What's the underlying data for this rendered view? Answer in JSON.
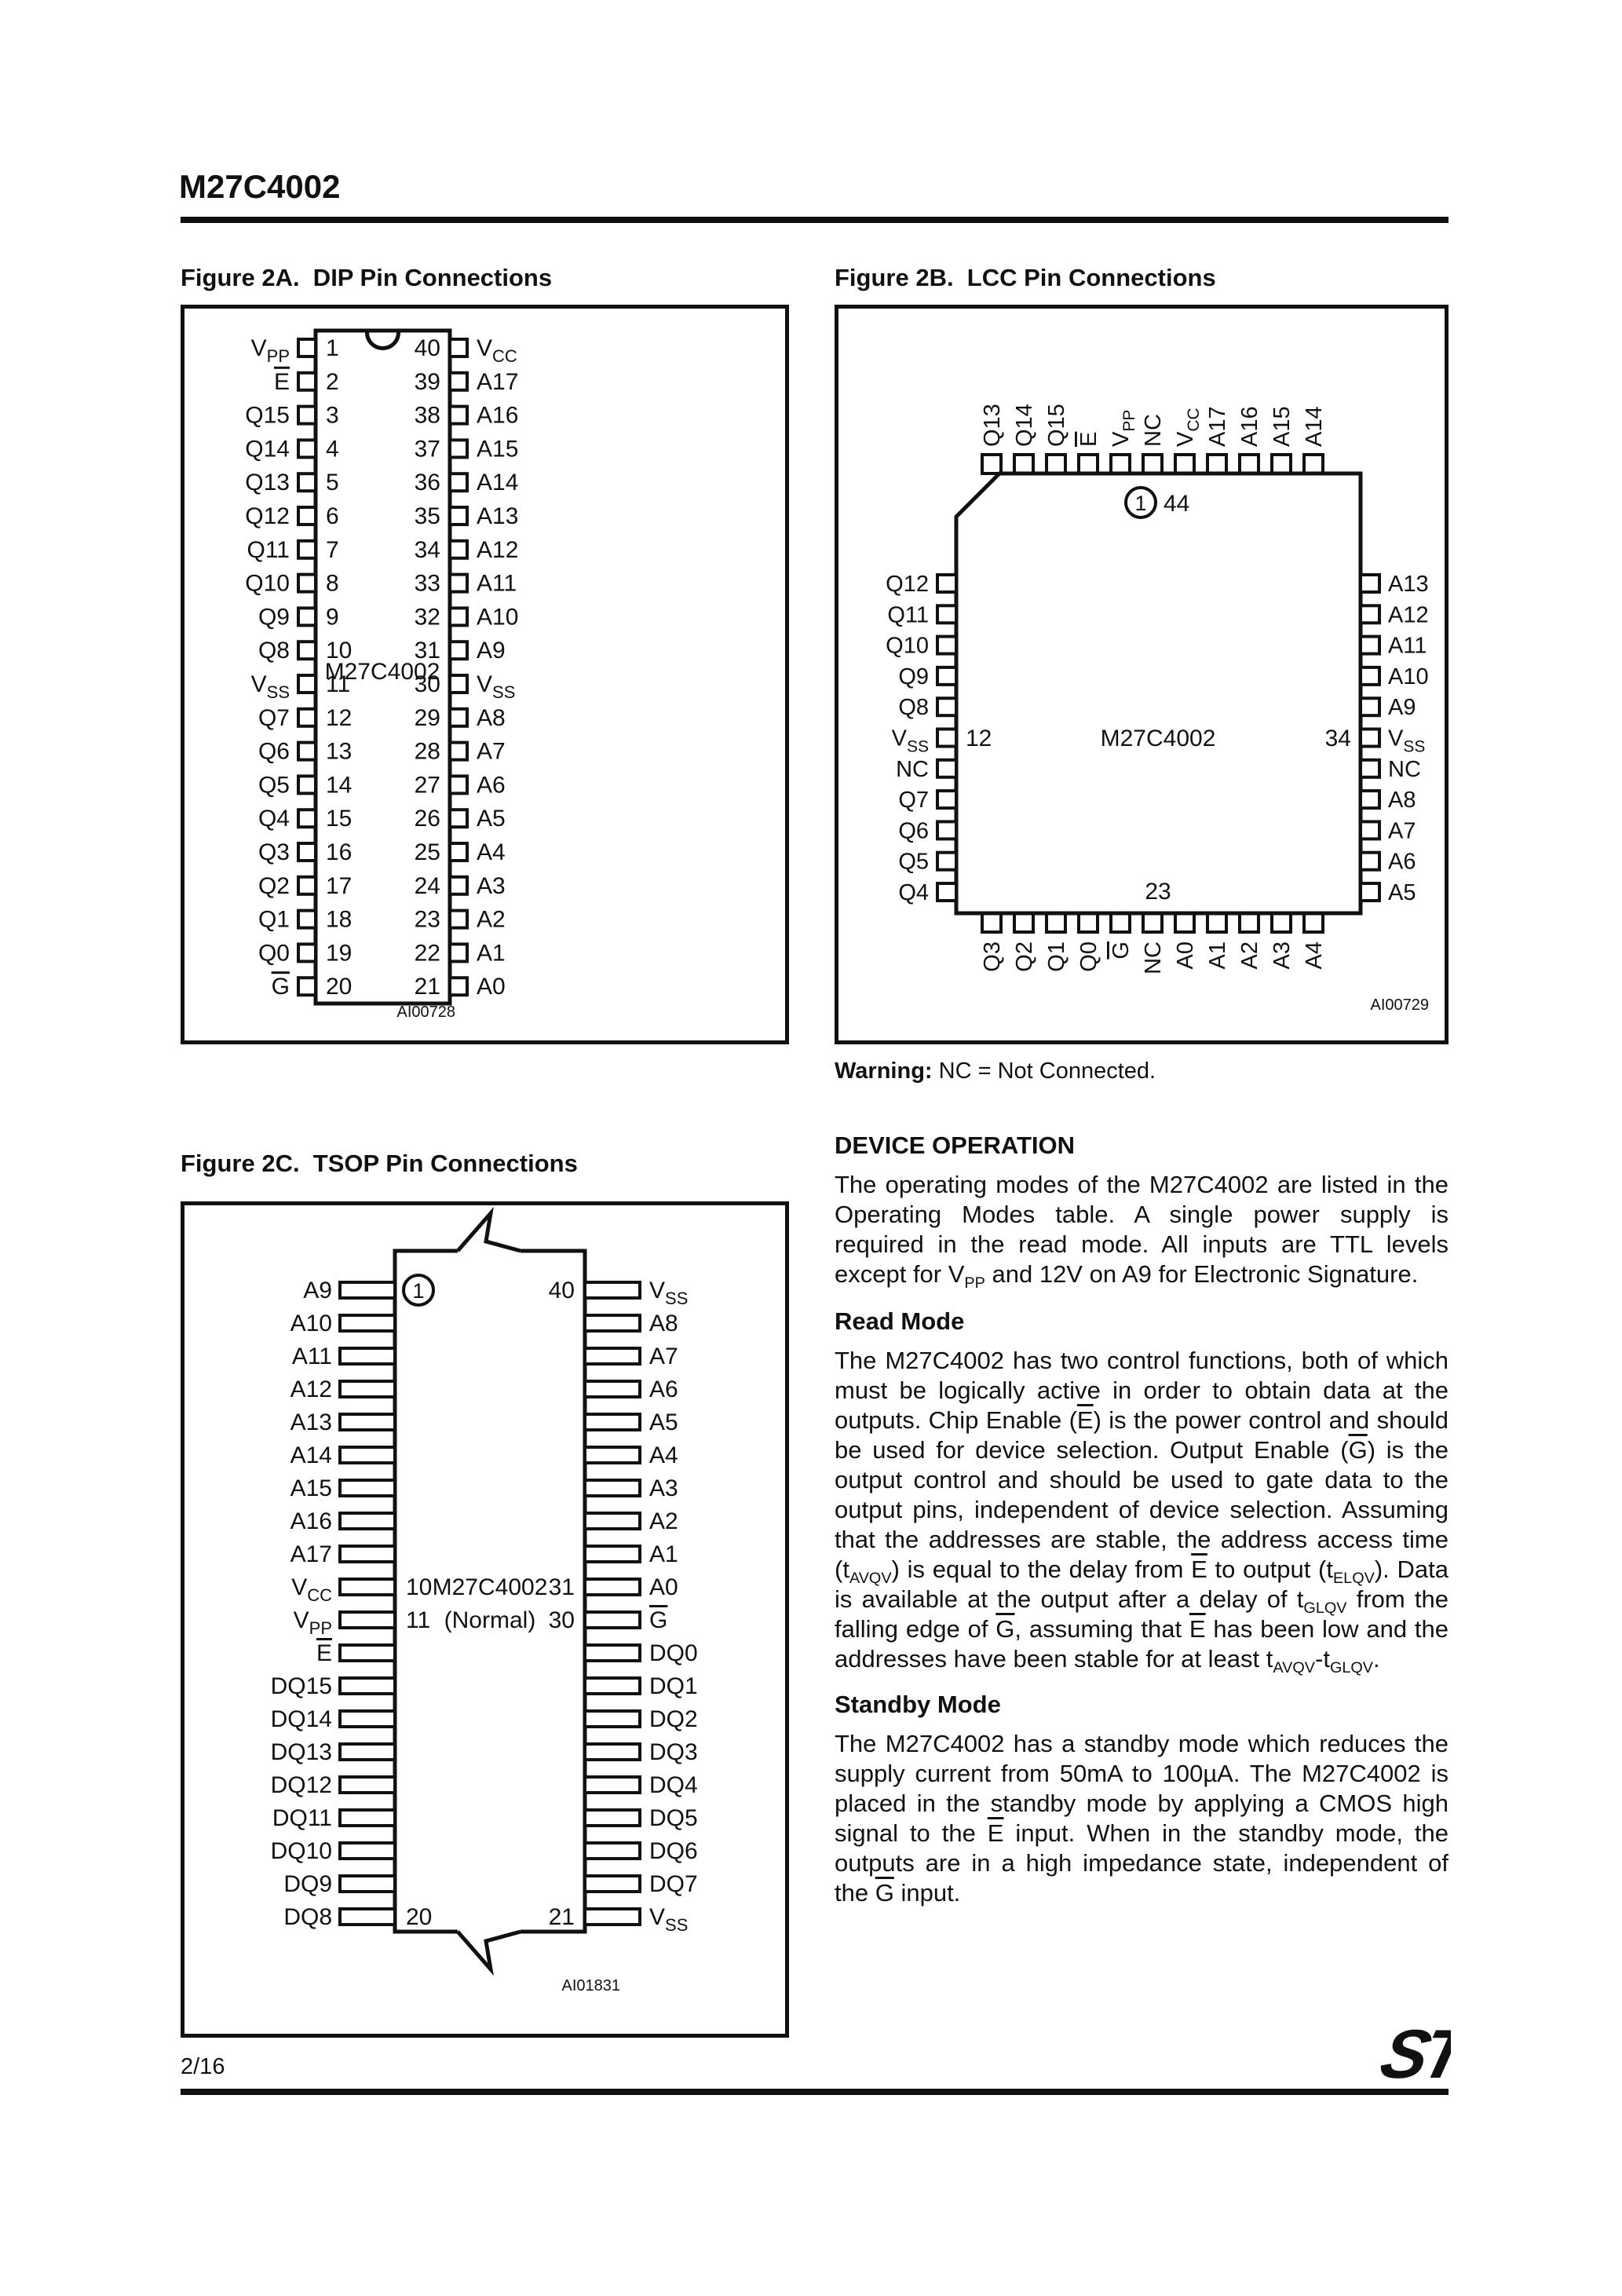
{
  "page": {
    "title": "M27C4002",
    "page_number": "2/16",
    "logo_text": "ST"
  },
  "figure_2a": {
    "title": "Figure 2A.  DIP Pin Connections",
    "chip_label": "M27C4002",
    "figure_code": "AI00728",
    "left_pins": [
      {
        "label": "V_PP",
        "num": "1"
      },
      {
        "label": "~E",
        "num": "2"
      },
      {
        "label": "Q15",
        "num": "3"
      },
      {
        "label": "Q14",
        "num": "4"
      },
      {
        "label": "Q13",
        "num": "5"
      },
      {
        "label": "Q12",
        "num": "6"
      },
      {
        "label": "Q11",
        "num": "7"
      },
      {
        "label": "Q10",
        "num": "8"
      },
      {
        "label": "Q9",
        "num": "9"
      },
      {
        "label": "Q8",
        "num": "10"
      },
      {
        "label": "V_SS",
        "num": "11"
      },
      {
        "label": "Q7",
        "num": "12"
      },
      {
        "label": "Q6",
        "num": "13"
      },
      {
        "label": "Q5",
        "num": "14"
      },
      {
        "label": "Q4",
        "num": "15"
      },
      {
        "label": "Q3",
        "num": "16"
      },
      {
        "label": "Q2",
        "num": "17"
      },
      {
        "label": "Q1",
        "num": "18"
      },
      {
        "label": "Q0",
        "num": "19"
      },
      {
        "label": "~G",
        "num": "20"
      }
    ],
    "right_pins": [
      {
        "label": "V_CC",
        "num": "40"
      },
      {
        "label": "A17",
        "num": "39"
      },
      {
        "label": "A16",
        "num": "38"
      },
      {
        "label": "A15",
        "num": "37"
      },
      {
        "label": "A14",
        "num": "36"
      },
      {
        "label": "A13",
        "num": "35"
      },
      {
        "label": "A12",
        "num": "34"
      },
      {
        "label": "A11",
        "num": "33"
      },
      {
        "label": "A10",
        "num": "32"
      },
      {
        "label": "A9",
        "num": "31"
      },
      {
        "label": "V_SS",
        "num": "30"
      },
      {
        "label": "A8",
        "num": "29"
      },
      {
        "label": "A7",
        "num": "28"
      },
      {
        "label": "A6",
        "num": "27"
      },
      {
        "label": "A5",
        "num": "26"
      },
      {
        "label": "A4",
        "num": "25"
      },
      {
        "label": "A3",
        "num": "24"
      },
      {
        "label": "A2",
        "num": "23"
      },
      {
        "label": "A1",
        "num": "22"
      },
      {
        "label": "A0",
        "num": "21"
      }
    ]
  },
  "figure_2b": {
    "title": "Figure 2B.  LCC Pin Connections",
    "chip_label": "M27C4002",
    "figure_code": "AI00729",
    "top_pins": [
      "Q13",
      "Q14",
      "Q15",
      "~E",
      "V_PP",
      "NC",
      "V_CC",
      "A17",
      "A16",
      "A15",
      "A14"
    ],
    "left_pins": [
      "Q12",
      "Q11",
      "Q10",
      "Q9",
      "Q8",
      "V_SS",
      "NC",
      "Q7",
      "Q6",
      "Q5",
      "Q4"
    ],
    "right_pins": [
      "A13",
      "A12",
      "A11",
      "A10",
      "A9",
      "V_SS",
      "NC",
      "A8",
      "A7",
      "A6",
      "A5"
    ],
    "bottom_pins": [
      "Q3",
      "Q2",
      "Q1",
      "Q0",
      "~G",
      "NC",
      "A0",
      "A1",
      "A2",
      "A3",
      "A4"
    ],
    "pin1_marker": "1",
    "pin44_label": "44",
    "pin12_label": "12",
    "pin34_label": "34",
    "pin23_label": "23",
    "warning_bold": "Warning:",
    "warning_text": " NC = Not Connected."
  },
  "figure_2c": {
    "title": "Figure 2C.  TSOP Pin Connections",
    "chip_label_line1": "M27C4002",
    "chip_label_line2": "(Normal)",
    "figure_code": "AI01831",
    "rows": [
      {
        "left": "A9",
        "right": "V_SS",
        "left_num": "(1)",
        "right_num": "40"
      },
      {
        "left": "A10",
        "right": "A8"
      },
      {
        "left": "A11",
        "right": "A7"
      },
      {
        "left": "A12",
        "right": "A6"
      },
      {
        "left": "A13",
        "right": "A5"
      },
      {
        "left": "A14",
        "right": "A4"
      },
      {
        "left": "A15",
        "right": "A3"
      },
      {
        "left": "A16",
        "right": "A2"
      },
      {
        "left": "A17",
        "right": "A1"
      },
      {
        "left": "V_CC",
        "right": "A0",
        "left_num": "10",
        "right_num": "31"
      },
      {
        "left": "V_PP",
        "right": "~G",
        "left_num": "11",
        "right_num": "30"
      },
      {
        "left": "~E",
        "right": "DQ0"
      },
      {
        "left": "DQ15",
        "right": "DQ1"
      },
      {
        "left": "DQ14",
        "right": "DQ2"
      },
      {
        "left": "DQ13",
        "right": "DQ3"
      },
      {
        "left": "DQ12",
        "right": "DQ4"
      },
      {
        "left": "DQ11",
        "right": "DQ5"
      },
      {
        "left": "DQ10",
        "right": "DQ6"
      },
      {
        "left": "DQ9",
        "right": "DQ7"
      },
      {
        "left": "DQ8",
        "right": "V_SS",
        "left_num": "20",
        "right_num": "21"
      }
    ]
  },
  "device_operation": {
    "heading": "DEVICE OPERATION",
    "intro": [
      [
        "t",
        "The operating modes of the M27C4002 are listed in the Operating Modes table. A single power supply is required in the read mode.  All inputs are TTL levels except for V"
      ],
      [
        "sub",
        "PP"
      ],
      [
        "t",
        " and 12V on A9 for Electronic Signature."
      ]
    ],
    "read_mode_heading": "Read Mode",
    "read_mode": [
      [
        "t",
        "The M27C4002 has two control functions, both of which must be logically active in order to obtain data at the outputs.  Chip Enable ("
      ],
      [
        "over",
        "E"
      ],
      [
        "t",
        ") is the power control and should be used for device selection. Output Enable ("
      ],
      [
        "over",
        "G"
      ],
      [
        "t",
        ") is the output control and should be used to gate data to the output pins, independent of device selection.  Assuming that the addresses are stable, the address access time (t"
      ],
      [
        "sub",
        "AVQV"
      ],
      [
        "t",
        ") is equal to the delay from "
      ],
      [
        "over",
        "E"
      ],
      [
        "t",
        " to output (t"
      ],
      [
        "sub",
        "ELQV"
      ],
      [
        "t",
        ").  Data is available at the output after a delay of t"
      ],
      [
        "sub",
        "GLQV"
      ],
      [
        "t",
        " from the falling edge of "
      ],
      [
        "over",
        "G"
      ],
      [
        "t",
        ", assuming that "
      ],
      [
        "over",
        "E"
      ],
      [
        "t",
        " has been low and the addresses have been stable for at least t"
      ],
      [
        "sub",
        "AVQV"
      ],
      [
        "t",
        "-t"
      ],
      [
        "sub",
        "GLQV"
      ],
      [
        "t",
        "."
      ]
    ],
    "standby_heading": "Standby Mode",
    "standby": [
      [
        "t",
        "The M27C4002 has a standby mode which reduces the supply current from 50mA to 100µA. The M27C4002 is placed in the standby mode by applying a CMOS high signal to the "
      ],
      [
        "over",
        "E"
      ],
      [
        "t",
        " input.  When in the standby mode, the outputs are in a high impedance state, independent of the "
      ],
      [
        "over",
        "G"
      ],
      [
        "t",
        " input."
      ]
    ]
  }
}
